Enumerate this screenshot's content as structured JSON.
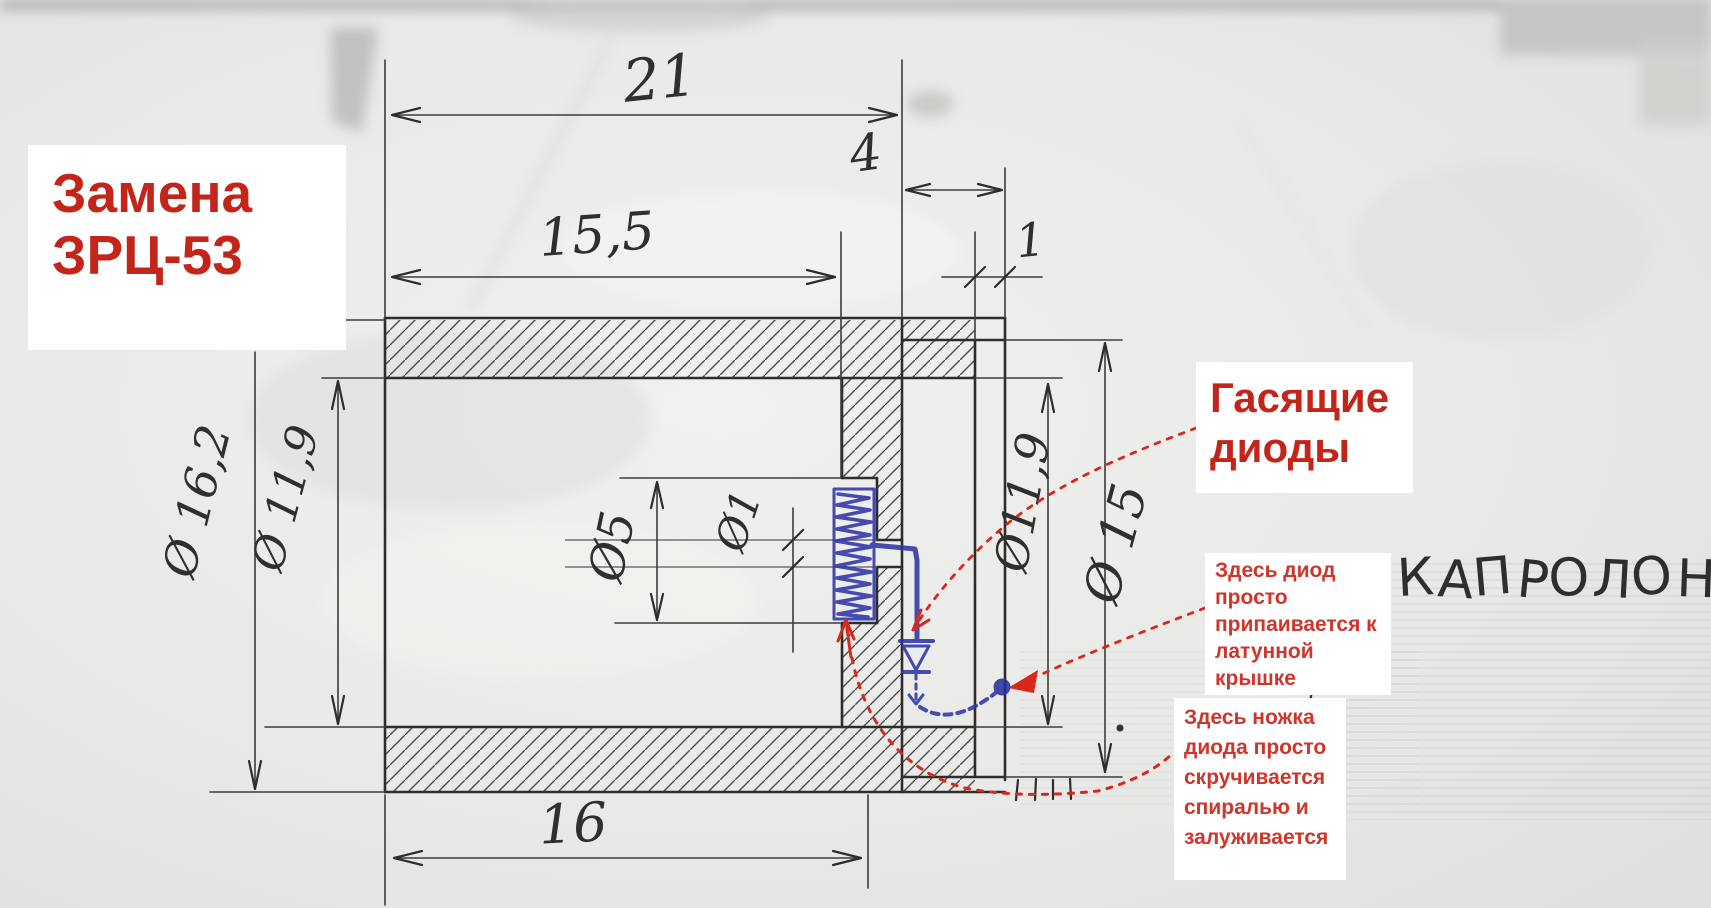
{
  "drawing": {
    "title_label": {
      "line1": "Замена",
      "line2": "ЗРЦ-53"
    },
    "callout_diodes": {
      "line1": "Гасящие",
      "line2": "диоды"
    },
    "note_solder_lines": [
      "Здесь диод",
      "просто",
      "припаивается к",
      "латунной",
      "крышке"
    ],
    "note_twist_lines": [
      "Здесь ножка",
      "диода просто",
      "скручивается",
      "спиралью и",
      "залуживается"
    ],
    "material_note": "КАПРОЛОН",
    "dimensions": {
      "total_length": "21",
      "cap_depth": "4",
      "bore_depth": "15,5",
      "cap_wall_thickness": "1",
      "outer_diameter": "Ø 16,2",
      "bore_diameter_left": "Ø 11,9",
      "pocket_diameter": "Ø5",
      "hole_diameter": "Ø1",
      "bore_diameter_right": "Ø11,9",
      "cap_diameter": "Ø 15",
      "bottom_length": "16"
    },
    "colors": {
      "annotation_red": "#c8271c",
      "ink_blue": "#2e34a8",
      "pencil": "#2f2f2f",
      "paper": "#e9e9e7",
      "label_background": "#ffffff"
    }
  }
}
